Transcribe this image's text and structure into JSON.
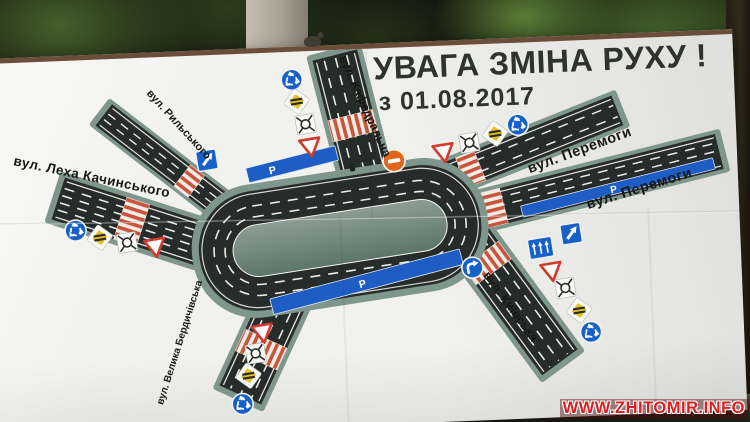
{
  "billboard": {
    "title": "УВАГА ЗМІНА РУХУ !",
    "subtitle": "з 01.08.2017",
    "parking_label": "P",
    "streets": {
      "lekha_kachynskoho": "вул. Леха Качинського",
      "rylskoho": "вул. Рильського",
      "kafedralna": "вул. Кафедральна",
      "peremohy_upper": "вул. Перемоги",
      "peremohy_lower": "вул. Перемоги",
      "velyka_berdychivska": "вул. Велика Бердичівська",
      "kyivska": "вул. Київська"
    },
    "signs": [
      "roundabout",
      "priority-road",
      "junction-circle",
      "give-way",
      "no-entry",
      "one-way",
      "lane-directions",
      "turn-right-only",
      "parking"
    ],
    "colors": {
      "road": "#262c29",
      "verge_green": "#7f968c",
      "parking_blue": "#1e5ec4",
      "sign_blue": "#1660c8",
      "zebra_red": "#c8543c",
      "no_entry_orange": "#e0661c",
      "priority_yellow": "#e5c223"
    }
  },
  "watermark": "WWW.ZHITOMIR.INFO"
}
